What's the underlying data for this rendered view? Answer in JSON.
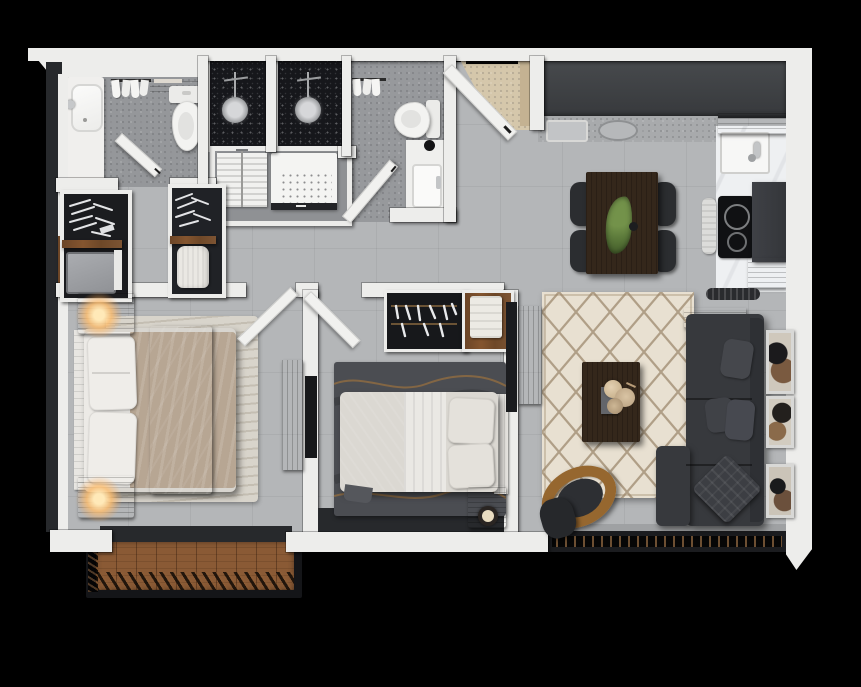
{
  "scene": {
    "type": "3d-floor-plan-render",
    "view": "top-down isometric",
    "description": "Photorealistic top-down 3D floor plan of a two-bedroom, two-bathroom apartment with open kitchen / dining / living area and balcony, on a black background",
    "visible_text": "none"
  },
  "palette": {
    "background": "#000000",
    "outer_wall_white": "#ededeb",
    "inner_wall_dark": "#27292c",
    "floor_main_gray": "#b4b6b8",
    "floor_bath_gray": "#95979a",
    "floor_entry_beige": "#d5c7ab",
    "shower_black_stone": "#16171b",
    "wood_brown": "#7d5433",
    "deck_wood": "#8a5a35",
    "fixture_white": "#f1f1ef",
    "sofa_charcoal": "#37393d",
    "living_rug_cream": "#e8e0d1",
    "rug_lattice_brown": "#8b7355",
    "bedroom2_rug_gray": "#4b4d52",
    "master_rug_beige": "#d8d4cb",
    "dining_table_wood": "#34271b",
    "plant_green": "#5e7c3c",
    "lamp_glow": "#ffc97e",
    "marble_white": "#edeef0",
    "cooktop_black": "#101113"
  },
  "rooms": [
    {
      "name": "bathroom-1",
      "items": [
        "bathtub",
        "toilet",
        "black-stone shower",
        "towel rack",
        "wood towel shelf",
        "open door"
      ]
    },
    {
      "name": "bathroom-2",
      "items": [
        "black-stone shower",
        "toilet",
        "vanity sink",
        "towel rack",
        "open door"
      ]
    },
    {
      "name": "laundry-closet",
      "items": [
        "drying rack",
        "washing machine"
      ]
    },
    {
      "name": "walk-in-closet",
      "items": [
        "wardrobe with hangers",
        "dresser",
        "hanging garment"
      ]
    },
    {
      "name": "master-bedroom",
      "items": [
        "double bed",
        "two nightstands with lit lamps",
        "area rug",
        "media console",
        "wall TV",
        "open door",
        "balcony wood deck"
      ]
    },
    {
      "name": "bedroom-2",
      "items": [
        "double bed",
        "open closet with hangers",
        "folded clothes shelf",
        "nightstand with candle",
        "dark area rug",
        "open door"
      ]
    },
    {
      "name": "entry",
      "items": [
        "open entry door",
        "beige entry floor"
      ]
    },
    {
      "name": "kitchen",
      "items": [
        "dark upper cabinets",
        "speckled counter with sink and basin",
        "marble counter",
        "kitchen sink with faucet",
        "cooktop",
        "tall cabinet",
        "wood shelves",
        "towel",
        "vent"
      ]
    },
    {
      "name": "dining-area",
      "items": [
        "dark wood dining table",
        "four black chairs",
        "green centerpiece plant"
      ]
    },
    {
      "name": "living-room",
      "items": [
        "cream berber rug",
        "coffee table with dried flowers",
        "round accent chair",
        "ottoman",
        "charcoal sectional sofa",
        "throw pillows",
        "sofa-back console",
        "three framed artworks",
        "balcony railing"
      ]
    }
  ],
  "labels": {
    "plan": "apartment 3d floor plan",
    "floor_main": "main gray floor",
    "floor_bath1": "bathroom 1 floor",
    "floor_bath2": "bathroom 2 floor",
    "entry_floor": "entry beige floor",
    "doorway": "entry doorway opening",
    "bathtub": "bathtub",
    "tub_faucet": "tub faucet",
    "toilet1": "toilet",
    "toilet2": "toilet",
    "shower1": "walk-in shower, black stone",
    "shower2": "walk-in shower, black stone",
    "shower_head": "rain shower head",
    "towel_rack": "towel rack with towels",
    "towel_shelf": "wood shelf with towels",
    "drying_rack": "drying rack",
    "washer": "washing machine",
    "vanity": "vanity sink",
    "soap": "soap dispenser",
    "wardrobe_a": "wardrobe with hangers",
    "wardrobe_b": "wardrobe with hangers",
    "dresser": "dresser",
    "garment": "hanging white garment",
    "closet2": "open closet with hangers",
    "clothes_shelf": "shelf with folded clothes",
    "master_rug": "master bedroom rug",
    "master_bed": "master double bed",
    "headboard": "headboard",
    "pillows": "pillows",
    "duvet": "duvet",
    "runner": "dark bed runner",
    "nightstand": "wood nightstand",
    "lamp": "lit table lamp",
    "console_master": "media console",
    "tv_panel": "wall tv panel",
    "bed2": "double bed",
    "blanket2": "dark gray blanket",
    "duvet2": "white duvet",
    "nightstand2": "wood nightstand",
    "candle": "candle",
    "rug2": "dark rug with gold waves",
    "kitchen_upper": "dark upper kitchen cabinets",
    "kitchen_counter": "speckled kitchen counter",
    "counter_sink": "inset counter sink",
    "counter_basin": "round counter basin",
    "marble_counter": "marble counter",
    "kitchen_sink": "kitchen sink",
    "faucet": "chrome faucet",
    "cooktop": "black cooktop",
    "tall_cabinet": "tall dark cabinet",
    "wood_shelf": "wood shelf",
    "kitchen_towel": "hanging kitchen towel",
    "vent": "floor vent",
    "dining_table": "dark wood dining table",
    "dining_chair": "black dining chair",
    "plant": "green centerpiece plant",
    "living_rug": "cream berber rug with diamond lattice",
    "coffee_table": "dark wood coffee table",
    "tray": "decor tray",
    "flowers": "dried flower arrangement",
    "accent_chair": "round wood accent chair",
    "ottoman": "dark ottoman",
    "sofa": "charcoal sectional sofa",
    "sofa_console": "wood console behind sofa",
    "sofa_pillow": "throw pillow",
    "quilt_pillow": "quilted throw pillow",
    "art": "framed abstract wall art",
    "deck": "balcony wood deck",
    "deck_rail": "balcony slat railing",
    "living_rail": "living room balcony railing",
    "sill": "balcony door sill",
    "threshold": "sliding door threshold",
    "door_leaf": "open door leaf",
    "entry_door": "open entry door",
    "wall": "wall"
  }
}
